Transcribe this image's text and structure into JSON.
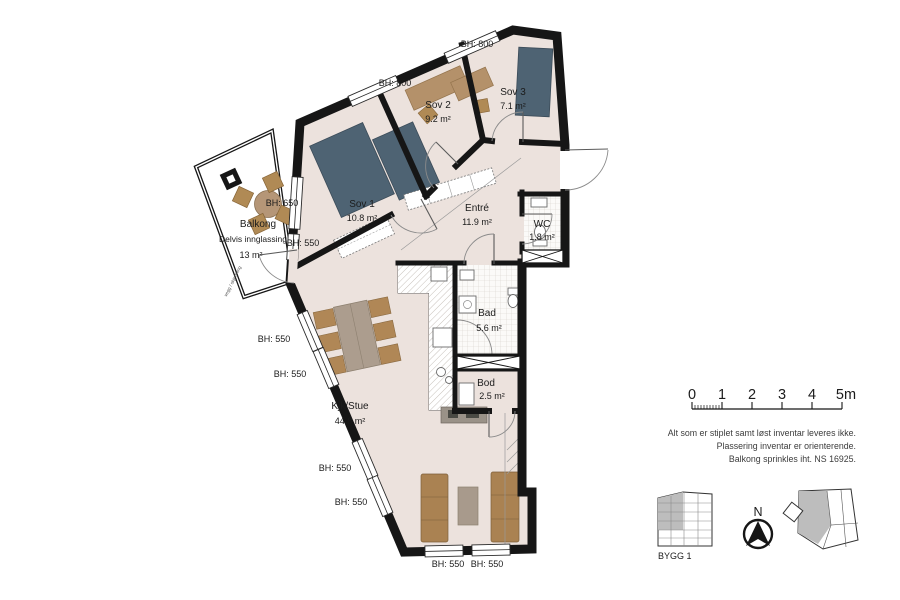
{
  "title": "Floor plan apartment",
  "rooms": [
    {
      "name": "Sov 1",
      "area": "10.8 m²"
    },
    {
      "name": "Sov 2",
      "area": "9.2 m²"
    },
    {
      "name": "Sov 3",
      "area": "7.1 m²"
    },
    {
      "name": "Entré",
      "area": "11.9 m²"
    },
    {
      "name": "WC",
      "area": "1.8 m²"
    },
    {
      "name": "Bad",
      "area": "5.6 m²"
    },
    {
      "name": "Bod",
      "area": "2.5 m²"
    },
    {
      "name": "Kjk/Stue",
      "area": "44.8 m²"
    },
    {
      "name": "Balkong",
      "sub": "Delvis innglassing",
      "area": "13 m²"
    }
  ],
  "sill_heights": [
    "BH: 800",
    "BH: 800",
    "BH: 650",
    "BH: 550",
    "BH: 550",
    "BH: 550",
    "BH: 550",
    "BH: 550",
    "BH: 550",
    "BH: 550"
  ],
  "scale_bar": {
    "ticks": [
      "0",
      "1",
      "2",
      "3",
      "4",
      "5m"
    ]
  },
  "notes": [
    "Alt som er stiplet samt løst inventar leveres ikke.",
    "Plassering inventar er orienterende.",
    "Balkong sprinkles iht. NS 16925."
  ],
  "legend": {
    "building_label": "BYGG 1",
    "north_label": "N"
  },
  "small_text": {
    "balcony_edge": "vegg / skjerming"
  },
  "colors": {
    "wall": "#161616",
    "floor": "#ece2dd",
    "bed": "#4e6373",
    "wood": "#b4916a",
    "sofa": "#aa8252",
    "shaded": "#bdbdbd"
  }
}
